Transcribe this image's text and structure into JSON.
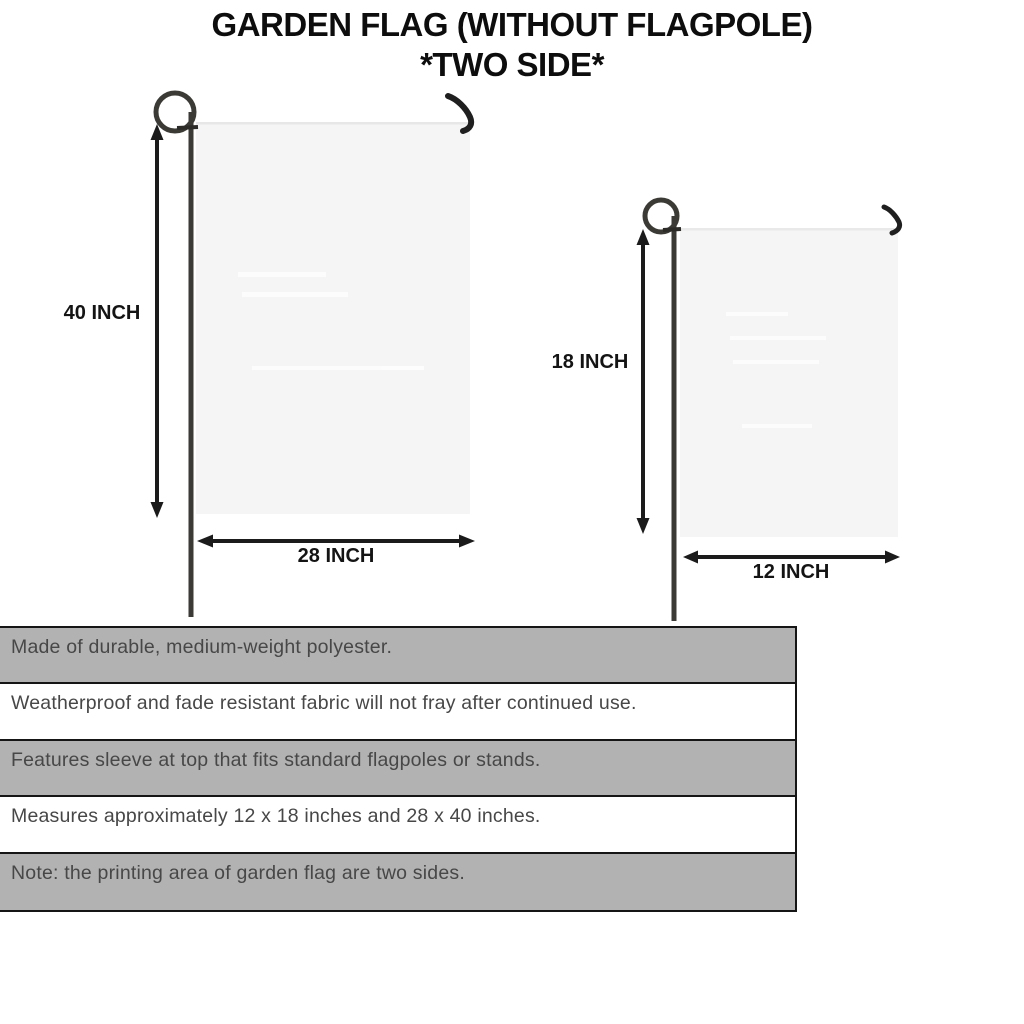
{
  "title": {
    "line1": "GARDEN FLAG (WITHOUT FLAGPOLE)",
    "line2": "*TWO SIDE*"
  },
  "diagram": {
    "large_flag": {
      "height_label": "40 INCH",
      "width_label": "28 INCH"
    },
    "small_flag": {
      "height_label": "18 INCH",
      "width_label": "12 INCH"
    }
  },
  "features": [
    "Made of durable, medium-weight polyester.",
    "Weatherproof and fade resistant fabric will not fray after continued use.",
    "Features sleeve at top that fits standard flagpoles or stands.",
    "Measures approximately 12 x 18 inches and 28 x 40 inches.",
    "Note: the printing area of garden flag are two sides."
  ],
  "colors": {
    "background": "#ffffff",
    "title_text": "#0d0d0d",
    "flag_fill": "#f5f5f6",
    "pole": "#3b3a35",
    "arrow": "#1b1b1b",
    "table_row_gray": "#b2b2b2",
    "table_row_white": "#ffffff",
    "table_border": "#151515",
    "table_text": "#474747"
  }
}
